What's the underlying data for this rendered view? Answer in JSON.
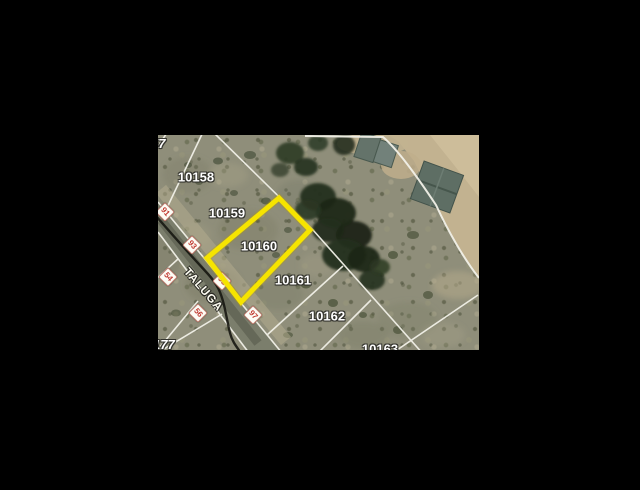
{
  "map": {
    "type": "aerial-parcel-map",
    "parcels": [
      {
        "apn": "10158",
        "highlighted": false
      },
      {
        "apn": "10159",
        "highlighted": false
      },
      {
        "apn": "10160",
        "highlighted": true
      },
      {
        "apn": "10161",
        "highlighted": false
      },
      {
        "apn": "10162",
        "highlighted": false
      },
      {
        "apn": "10163",
        "highlighted": false
      }
    ],
    "clipped_labels": {
      "top_left": "57",
      "bottom_left": "177"
    },
    "street": {
      "name": "TALUGA"
    },
    "address_markers": [
      {
        "number": "91"
      },
      {
        "number": "93"
      },
      {
        "number": "95"
      },
      {
        "number": "97"
      },
      {
        "number": "54"
      },
      {
        "number": "56"
      }
    ],
    "colors": {
      "highlight": "#F6E400",
      "marker_text": "#C23B33",
      "boundary_line": "#F2F1E8",
      "letterbox": "#000000"
    }
  }
}
